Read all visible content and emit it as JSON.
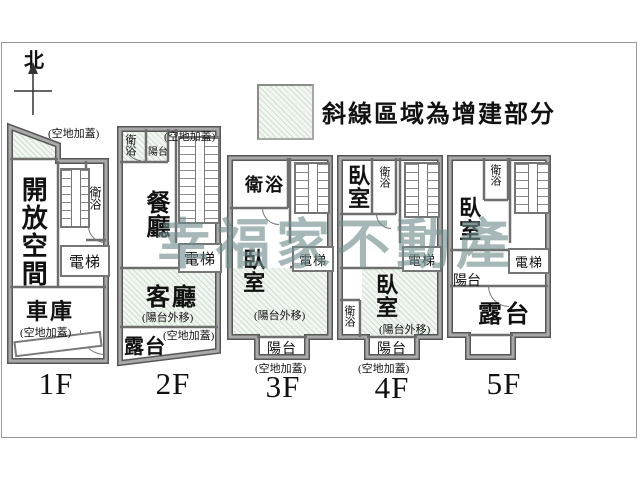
{
  "compass": {
    "label": "北"
  },
  "legend": {
    "text": "斜線區域為增建部分"
  },
  "watermark": {
    "text": "幸福家不動產",
    "color": "rgba(110,141,138,0.62)"
  },
  "colors": {
    "wall": "#7f7f7f",
    "wall_partition": "#6e6e6e",
    "hatch_fill": "#f1f6f0",
    "hatch_line": "#c8dcc8",
    "frame": "#9a9a9a",
    "watermark": "#6e8d8a"
  },
  "floors": [
    {
      "name": "1F",
      "rooms": {
        "open_space": "開放空間",
        "bath": "衛浴",
        "elevator": "電梯",
        "garage": "車庫"
      },
      "notes": {
        "top": "(空地加蓋)",
        "bottom": "(空地加蓋)"
      }
    },
    {
      "name": "2F",
      "rooms": {
        "bath": "衛浴",
        "balcony": "陽台",
        "dining": "餐廳",
        "elevator": "電梯",
        "living": "客廳",
        "terrace": "露台"
      },
      "notes": {
        "top": "(空地加蓋)",
        "balcony_moved": "(陽台外移)",
        "ground": "(空地加蓋)"
      }
    },
    {
      "name": "3F",
      "rooms": {
        "bath": "衛浴",
        "bedroom": "臥室",
        "elevator": "電梯",
        "balcony": "陽台"
      },
      "notes": {
        "balcony_moved": "(陽台外移)",
        "ground": "(空地加蓋)"
      }
    },
    {
      "name": "4F",
      "rooms": {
        "bedroom_front": "臥室",
        "bath_front": "衛浴",
        "elevator": "電梯",
        "bedroom_rear": "臥室",
        "bath_rear": "衛浴",
        "balcony": "陽台"
      },
      "notes": {
        "balcony_moved": "(陽台外移)",
        "ground": "(空地加蓋)"
      }
    },
    {
      "name": "5F",
      "rooms": {
        "bedroom": "臥室",
        "bath": "衛浴",
        "elevator": "電梯",
        "balcony": "陽台",
        "terrace": "露台"
      },
      "notes": {}
    }
  ]
}
